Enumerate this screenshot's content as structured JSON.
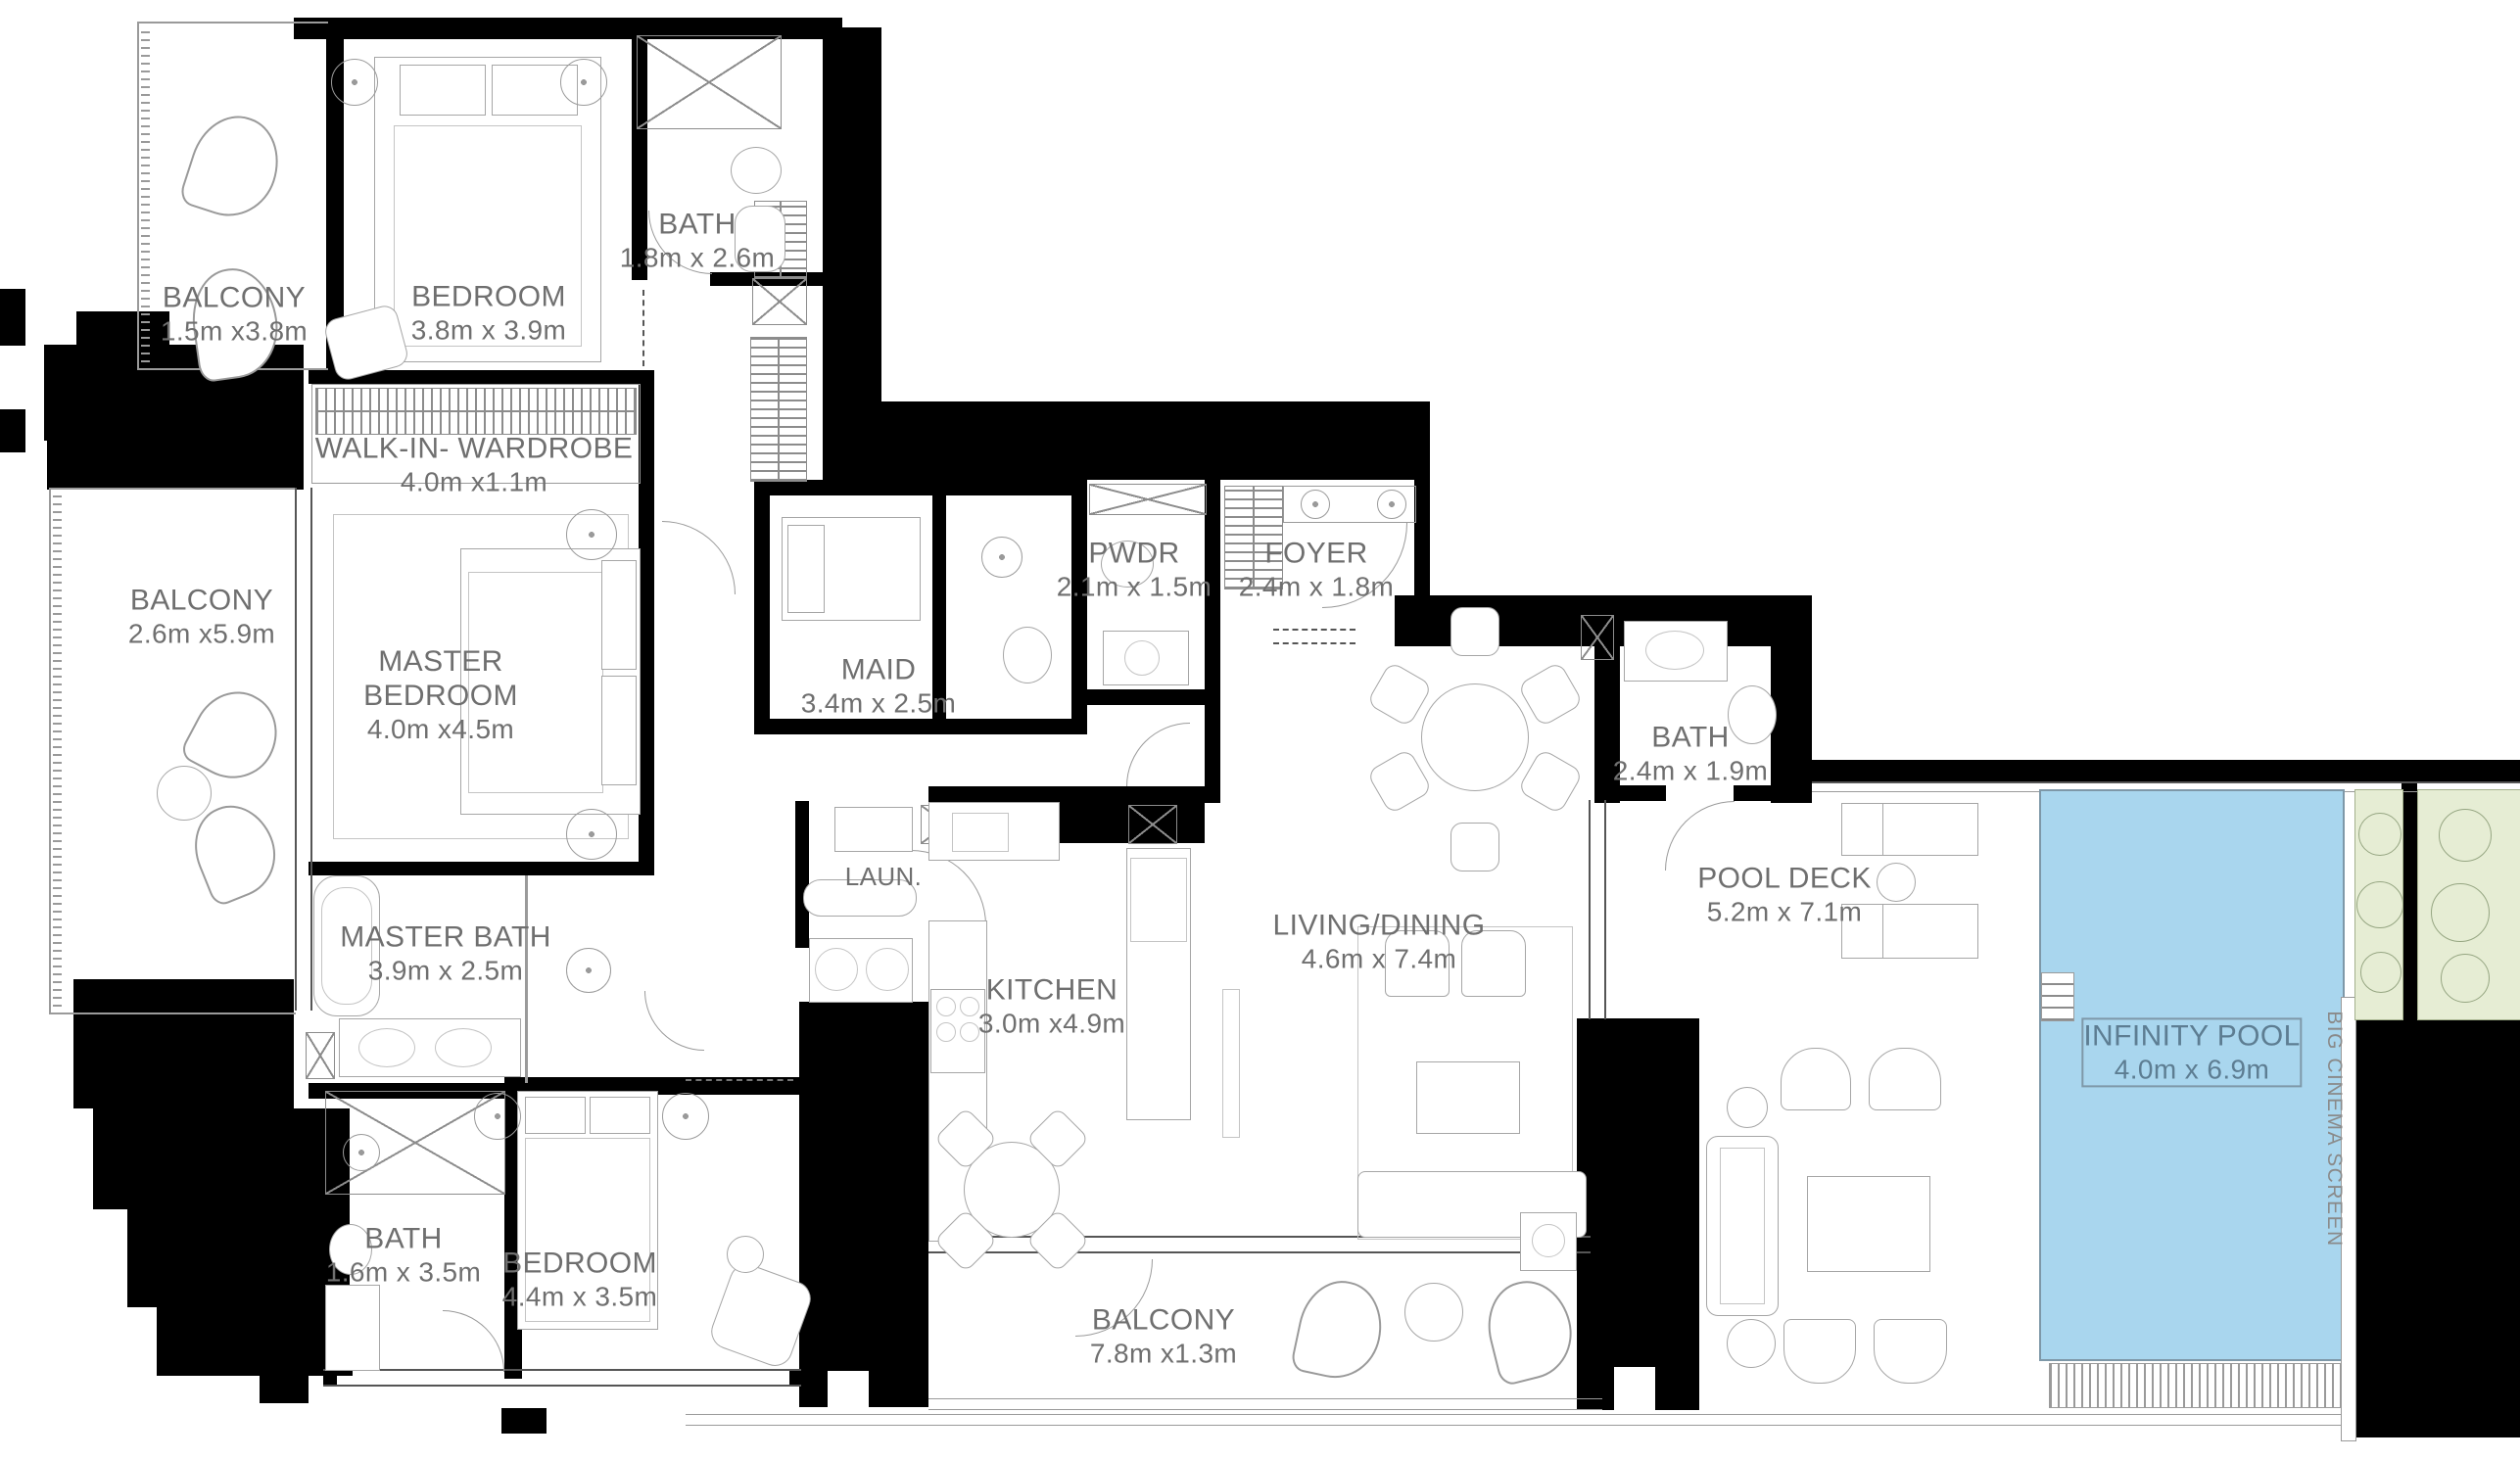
{
  "plan": {
    "type": "apartment-floor-plan",
    "colors": {
      "walls": "#000000",
      "pool_fill": "#a9d6ee",
      "pool_label": "#5d7d92",
      "planter_fill": "#e6edd4",
      "label_text": "#6f6f6f",
      "line": "#9a9a9a"
    },
    "rooms": [
      {
        "id": "balcony-top",
        "name": "BALCONY",
        "dims": "1.5m x3.8m"
      },
      {
        "id": "bedroom-top",
        "name": "BEDROOM",
        "dims": "3.8m x 3.9m"
      },
      {
        "id": "bath-top",
        "name": "BATH",
        "dims": "1.8m x 2.6m"
      },
      {
        "id": "walk-in-wardrobe",
        "name": "WALK-IN- WARDROBE",
        "dims": "4.0m x1.1m"
      },
      {
        "id": "master-bedroom",
        "name": "MASTER BEDROOM",
        "dims": "4.0m x4.5m"
      },
      {
        "id": "balcony-left",
        "name": "BALCONY",
        "dims": "2.6m x5.9m"
      },
      {
        "id": "maid",
        "name": "MAID",
        "dims": "3.4m x 2.5m"
      },
      {
        "id": "pwdr",
        "name": "PWDR",
        "dims": "2.1m x 1.5m"
      },
      {
        "id": "foyer",
        "name": "FOYER",
        "dims": "2.4m x 1.8m"
      },
      {
        "id": "bath-guest",
        "name": "BATH",
        "dims": "2.4m x 1.9m"
      },
      {
        "id": "living-dining",
        "name": "LIVING/DINING",
        "dims": "4.6m x 7.4m"
      },
      {
        "id": "laundry",
        "name": "LAUN.",
        "dims": ""
      },
      {
        "id": "kitchen",
        "name": "KITCHEN",
        "dims": "3.0m x4.9m"
      },
      {
        "id": "master-bath",
        "name": "MASTER BATH",
        "dims": "3.9m x 2.5m"
      },
      {
        "id": "bath-lower",
        "name": "BATH",
        "dims": "1.6m x 3.5m"
      },
      {
        "id": "bedroom-lower",
        "name": "BEDROOM",
        "dims": "4.4m x 3.5m"
      },
      {
        "id": "balcony-bottom",
        "name": "BALCONY",
        "dims": "7.8m x1.3m"
      },
      {
        "id": "pool-deck",
        "name": "POOL DECK",
        "dims": "5.2m x 7.1m"
      },
      {
        "id": "infinity-pool",
        "name": "INFINITY POOL",
        "dims": "4.0m x 6.9m"
      },
      {
        "id": "cinema-screen",
        "name": "BIG CINEMA SCREEN",
        "dims": ""
      }
    ]
  }
}
